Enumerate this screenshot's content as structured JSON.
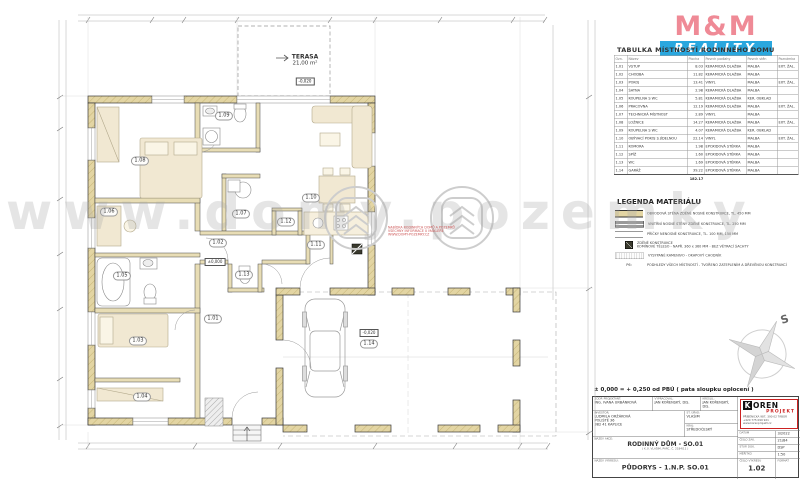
{
  "brand": {
    "mm_top": "M&M",
    "mm_bottom": "REALITY"
  },
  "watermark": {
    "text": "www.domy.pozemky",
    "disclaimer": "NABÍDKA RODINNÝCH DOMŮ A POZEMKŮ\nVŠECHNY INFORMACE U MAKLÉŘE\nWWW.DOMY-POZEMKY.CZ"
  },
  "room_table": {
    "title": "TABULKA MÍSTNOSTÍ RODINNÉHO DOMU",
    "headers": [
      "Ozn.",
      "Název",
      "Plocha",
      "Povrch podlahy",
      "Povrch stěn",
      "Poznámka"
    ],
    "rows": [
      [
        "1.01",
        "VSTUP",
        "8.03",
        "KERAMICKÁ DLAŽBA",
        "MALBA",
        "EXT. ŽAL."
      ],
      [
        "1.02",
        "CHODBA",
        "11.82",
        "KERAMICKÁ DLAŽBA",
        "MALBA",
        ""
      ],
      [
        "1.03",
        "POKOJ",
        "13.41",
        "VINYL",
        "MALBA",
        "EXT. ŽAL."
      ],
      [
        "1.04",
        "ŠATNA",
        "2.98",
        "KERAMICKÁ DLAŽBA",
        "MALBA",
        ""
      ],
      [
        "1.05",
        "KOUPELNA S WC",
        "5.81",
        "KERAMICKÁ DLAŽBA",
        "KER. OBKLAD",
        ""
      ],
      [
        "1.06",
        "PRACOVNA",
        "12.19",
        "KERAMICKÁ DLAŽBA",
        "MALBA",
        "EXT. ŽAL."
      ],
      [
        "1.07",
        "TECHNICKÁ MÍSTNOST",
        "2.89",
        "VINYL",
        "MALBA",
        ""
      ],
      [
        "1.08",
        "LOŽNICE",
        "14.27",
        "KERAMICKÁ DLAŽBA",
        "MALBA",
        "EXT. ŽAL."
      ],
      [
        "1.09",
        "KOUPELNA S WC",
        "4.07",
        "KERAMICKÁ DLAŽBA",
        "KER. OBKLAD",
        ""
      ],
      [
        "1.10",
        "OBÝVACÍ POKOJ S JÍDELNOU",
        "22.14",
        "VINYL",
        "MALBA",
        "EXT. ŽAL."
      ],
      [
        "1.11",
        "KOMORA",
        "1.98",
        "EPOXIDOVÁ STĚRKA",
        "MALBA",
        ""
      ],
      [
        "1.12",
        "SPÍŽ",
        "1.60",
        "EPOXIDOVÁ STĚRKA",
        "MALBA",
        ""
      ],
      [
        "1.13",
        "WC",
        "1.69",
        "EPOXIDOVÁ STĚRKA",
        "MALBA",
        ""
      ],
      [
        "1.14",
        "GARÁŽ",
        "39.22",
        "EPOXIDOVÁ STĚRKA",
        "MALBA",
        ""
      ]
    ],
    "total": "182.17"
  },
  "legend": {
    "title": "LEGENDA MATERIÁLU",
    "items": [
      {
        "swatch": "sw-ext",
        "tag": "",
        "text": "OBVODOVÁ STĚNA ZDĚNÉ NOSNÉ KONSTRUKCE, TL. 450 MM"
      },
      {
        "swatch": "sw-int",
        "tag": "",
        "text": "VNITŘNÍ NOSNÉ STĚNY ZDĚNÉ KONSTRUKCE, TL. 250 MM"
      },
      {
        "swatch": "sw-part",
        "tag": "",
        "text": "PŘÍČKY NENOSNÉ KONSTRUKCE, TL. 100 MM, 150 MM"
      },
      {
        "swatch": "sw-chim",
        "tag": "",
        "text": "ZDĚNÉ KONSTRUKCE\nKOMÍNOVÉ TĚLESO - NAPŘ. 360 x 360 MM - BEZ VĚTRACÍ ŠACHTY"
      },
      {
        "swatch": "sw-grav",
        "tag": "",
        "text": "VYSYPANÉ KAMENIVO - OKAPOVÝ CHODNÍK"
      },
      {
        "swatch": "sw-note",
        "tag": "P6:",
        "text": "PODHLEDY VŠECH MÍSTNOSTÍ - TVOŘENO ZATEPLENÍM A DŘEVĚNOU KONSTRUKCÍ"
      }
    ]
  },
  "compass": {
    "label": "S"
  },
  "scale_note": "± 0,000 = + 0,250 od PBÚ  ( pata sloupku oplocení )",
  "titleblock": {
    "zodp_label": "ZODP. PROJEKTANT:",
    "zodp": "ING. IVANA URBÁNKOVÁ",
    "vypracoval_label": "VYPRACOVAL:",
    "vypracoval": "JAN KOŘENSKÝ, DiS.",
    "kreslil_label": "KRESLIL:",
    "kreslil": "JAN KOŘENSKÝ, DiS.",
    "investor_label": "INVESTOR:",
    "investor": "LUDMILA ORŽÁKOVÁ\nPOLIŠTĚ 36\n382 41 KAPLICE",
    "st_urad_label": "ST. ÚŘAD:",
    "st_urad": "VLAŠIM",
    "kraj_label": "KRAJ:",
    "kraj": "STŘEDOČESKÝ",
    "logo_k": "K",
    "logo_oren": "OREN",
    "logo_projekt": "PROJEKT",
    "logo_addr": "PŘÍBĚNICKÁ 987, 390 02 TÁBOR\n+420 775 099 921\nwww.korenprojekt.cz",
    "datum_label": "DATUM",
    "datum": "3/2022",
    "cislo_zak_label": "ČÍSLO ZAK.",
    "cislo_zak": "21/84",
    "stup_label": "STUP. DOK.",
    "stup": "DSP",
    "meritko_label": "MĚŘÍTKO",
    "meritko": "1:50",
    "akce_label": "NÁZEV AKCE:",
    "akce": "RODINNÝ DŮM  -  SO.01",
    "akce_sub": "( K.Ú. VLAŠIM, PARC. Č. 2184/11 )",
    "vykres_label": "NÁZEV VÝKRESU:",
    "vykres": "PŮDORYS - 1.N.P.   SO.01",
    "cislo_vyk_label": "ČÍSLO VÝKRESU",
    "cislo_vyk": "1.02",
    "format_label": "FORMÁT",
    "format": ""
  },
  "plan": {
    "terrace": {
      "name": "TERASA",
      "area": "21,00 m²",
      "elev": "-0,020"
    },
    "garage_elev": "-0,020",
    "floor_elev": "±0,000",
    "rooms": [
      {
        "id": "1.01",
        "x": 213,
        "y": 319
      },
      {
        "id": "1.02",
        "x": 218,
        "y": 243
      },
      {
        "id": "1.03",
        "x": 138,
        "y": 341
      },
      {
        "id": "1.04",
        "x": 142,
        "y": 397
      },
      {
        "id": "1.05",
        "x": 122,
        "y": 276
      },
      {
        "id": "1.06",
        "x": 109,
        "y": 212
      },
      {
        "id": "1.07",
        "x": 241,
        "y": 214
      },
      {
        "id": "1.08",
        "x": 140,
        "y": 161
      },
      {
        "id": "1.09",
        "x": 224,
        "y": 116
      },
      {
        "id": "1.10",
        "x": 311,
        "y": 198
      },
      {
        "id": "1.11",
        "x": 316,
        "y": 245
      },
      {
        "id": "1.12",
        "x": 286,
        "y": 222
      },
      {
        "id": "1.13",
        "x": 244,
        "y": 275
      },
      {
        "id": "1.14",
        "x": 369,
        "y": 344
      }
    ]
  }
}
